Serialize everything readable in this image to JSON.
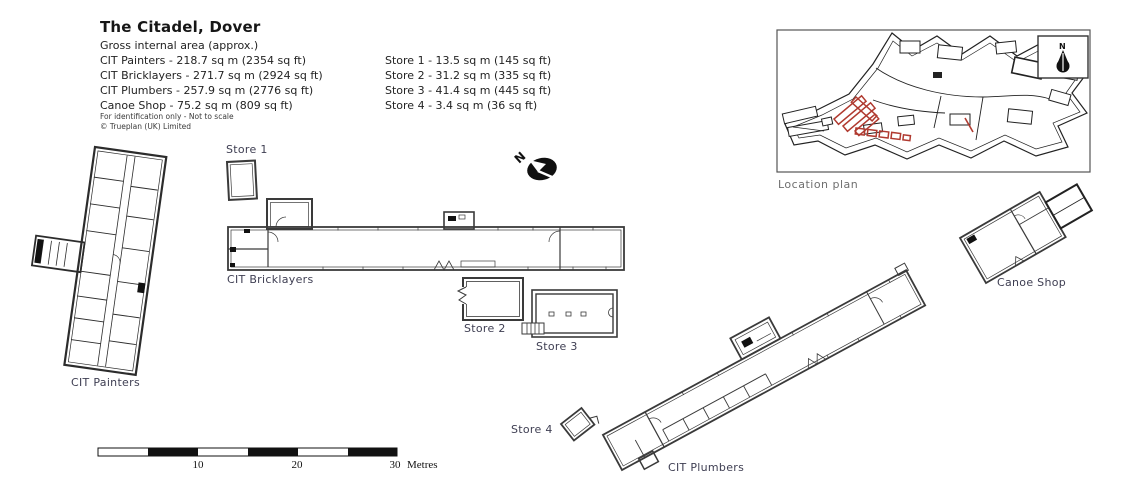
{
  "header": {
    "title": "The Citadel, Dover",
    "subtitle": "Gross internal area (approx.)",
    "areas_left": [
      "CIT Painters - 218.7 sq m (2354 sq ft)",
      "CIT Bricklayers - 271.7 sq m (2924 sq ft)",
      "CIT Plumbers - 257.9 sq m (2776 sq ft)",
      "Canoe Shop - 75.2 sq m (809 sq ft)"
    ],
    "areas_right": [
      "Store 1 - 13.5 sq m (145 sq ft)",
      "Store 2 - 31.2 sq m (335 sq ft)",
      "Store 3 - 41.4 sq m (445 sq ft)",
      "Store 4 - 3.4 sq m (36 sq ft)"
    ],
    "disclaimer": "For identification only - Not to scale",
    "copyright": "© Trueplan (UK) Limited"
  },
  "labels": {
    "cit_painters": "CIT Painters",
    "cit_bricklayers": "CIT Bricklayers",
    "cit_plumbers": "CIT Plumbers",
    "canoe_shop": "Canoe Shop",
    "store1": "Store 1",
    "store2": "Store 2",
    "store3": "Store 3",
    "store4": "Store 4",
    "location_plan": "Location plan",
    "north": "N"
  },
  "scale_bar": {
    "ticks": [
      "10",
      "20",
      "30"
    ],
    "unit": "Metres"
  },
  "colors": {
    "plan_line": "#3a3a3a",
    "location_line": "#222222",
    "highlight_red": "#b03a30",
    "label_text": "#3e3e52",
    "location_label": "#6f6f6f"
  }
}
